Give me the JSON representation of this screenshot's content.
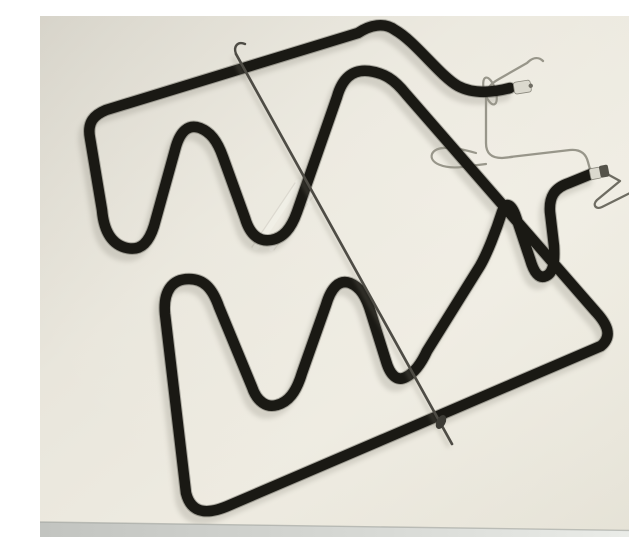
{
  "scene": {
    "subject": "Product photo of an electric oven heating element (grill/bake resistance) lying on a plain light surface",
    "view": "tilted top view, terminals at the right",
    "components": {
      "tube": "black tubular heating loop with serpentine bends",
      "support_rod": "thin dark support rod crossing the element diagonally",
      "mounting_wire": "thin steel mounting wire with clamps near the terminals",
      "terminal_upper": "upper terminal pin with ceramic/metal tip",
      "terminal_lower": "lower terminal pin with dark cap and bent wire end",
      "watermark": "faint pale diagonal glare marks at the centre",
      "table_edge": "light grey strip along the bottom edge of the photo"
    },
    "colors": {
      "background": "#eae7dd",
      "background_corner": "#d6d3c9",
      "tube": "#1a1914",
      "tube_soft_edge": "#3a3830",
      "shadow": "#6b685c",
      "rod": "#4e4c45",
      "rod_clip": "#3c3b35",
      "wire": "#98968a",
      "wire_dark": "#6e6c62",
      "tip_light": "#dbd9ce",
      "tip_dark": "#55534a",
      "pin": "#6f6d63",
      "watermark": "#f1efe7",
      "watermark_edge": "#c9c6bb",
      "strip": "#d2d4d0",
      "strip_line": "#9fa19d"
    }
  }
}
